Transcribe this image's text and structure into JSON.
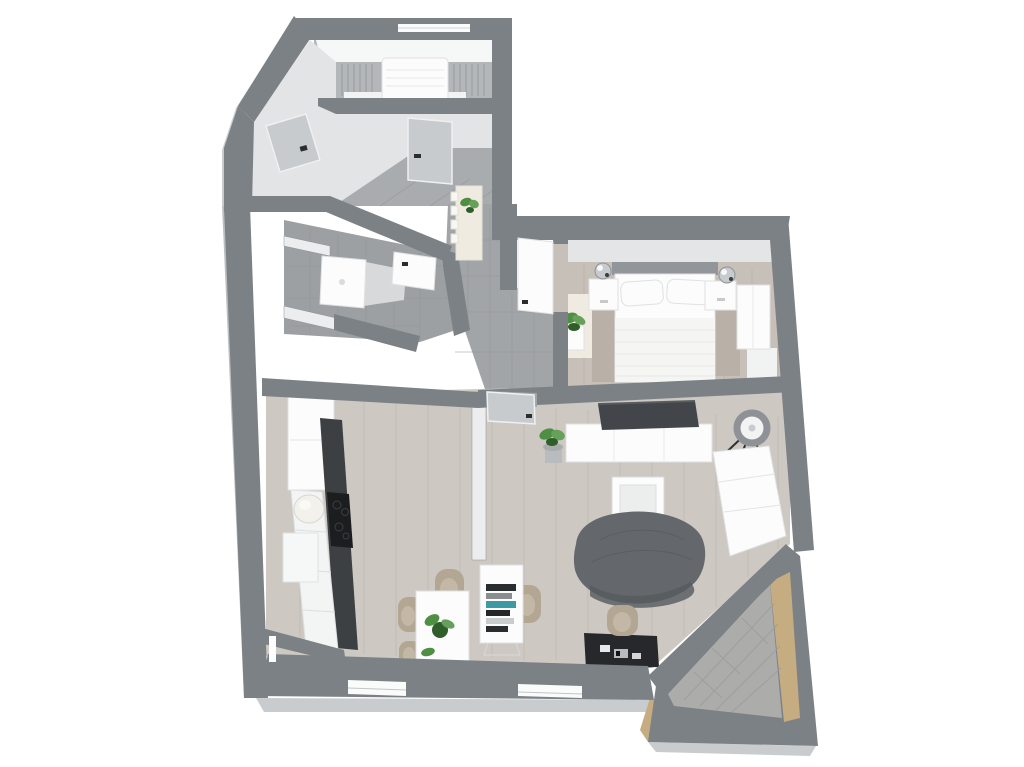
{
  "meta": {
    "description": "3D rendered top-down floor plan of a one-bedroom apartment with bathroom, entry hall, shower room, hallway, bedroom, open kitchen and living room, and a triangular tiled terrace",
    "canvas": {
      "width": 1024,
      "height": 767
    }
  },
  "colors": {
    "bg": "#ffffff",
    "wall": "#7c8185",
    "wallFace": "#c9cccf",
    "wallFaceDark": "#bcbfc2",
    "whiteWall": "#ecedee",
    "floorWood": "#cdc8c2",
    "floorWoodSeam": "#bab3ab",
    "floorWoodDark": "#b9b1a7",
    "floorBedroom": "#c7c0b8",
    "floorBedroomSeam": "#b4ada4",
    "tileHall": "#a2a5a8",
    "tileEntry": "#a9acae",
    "tileWC": "#9ca0a3",
    "tileSeam": "#8f9295",
    "tileBathWall": "#b3b7ba",
    "bathHatch": "#9fa3a6",
    "floorLight": "#e3e4e5",
    "cream": "#efebe0",
    "terrTile": "#acacaa",
    "terrSeam": "#9b9b98",
    "terrTrim": "#c5ac81",
    "white": "#fcfcfd",
    "furnitureBorder": "#dfe1e3",
    "backWall": "#e4e5e6",
    "tv": "#42464a",
    "sofa": "#64686c",
    "sofaDark": "#555a5e",
    "desk": "#26282b",
    "counter": "#3c4043",
    "cooktop": "#1b1d1f",
    "chairTan": "#b3a794",
    "chairTanInner": "#c3b8a5",
    "plantGreen": "#4e8f44",
    "plantGreen2": "#67a05b",
    "plantDark": "#2f5e2b",
    "chrome": "#c8cbcd",
    "chromeRim": "#8f9396",
    "doorGray": "#c8cbcd",
    "handle": "#2b2d2f",
    "potGray": "#b9bcbe",
    "windowWhite": "#fafbfb"
  },
  "scene": {
    "rooms": [
      {
        "id": "bathroom"
      },
      {
        "id": "entry-hall"
      },
      {
        "id": "shower-room"
      },
      {
        "id": "hallway"
      },
      {
        "id": "bedroom"
      },
      {
        "id": "living-room"
      },
      {
        "id": "kitchen"
      },
      {
        "id": "terrace"
      }
    ],
    "furniture": [
      {
        "id": "bathtub",
        "room": "bathroom"
      },
      {
        "id": "shower-tray",
        "room": "shower-room"
      },
      {
        "id": "hall-wardrobe",
        "room": "hallway"
      },
      {
        "id": "bed",
        "room": "bedroom"
      },
      {
        "id": "nightstand-left",
        "room": "bedroom"
      },
      {
        "id": "nightstand-right",
        "room": "bedroom"
      },
      {
        "id": "bedside-lamp-left",
        "room": "bedroom"
      },
      {
        "id": "bedside-lamp-right",
        "room": "bedroom"
      },
      {
        "id": "bedroom-wardrobe",
        "room": "bedroom"
      },
      {
        "id": "tv-sideboard",
        "room": "living-room"
      },
      {
        "id": "tv",
        "room": "living-room"
      },
      {
        "id": "floor-lamp",
        "room": "living-room"
      },
      {
        "id": "drawer-cabinet",
        "room": "living-room"
      },
      {
        "id": "coffee-table",
        "room": "living-room"
      },
      {
        "id": "sofa",
        "room": "living-room"
      },
      {
        "id": "desk",
        "room": "living-room"
      },
      {
        "id": "desk-chair",
        "room": "living-room"
      },
      {
        "id": "bookshelf",
        "room": "living-room"
      },
      {
        "id": "dining-table",
        "room": "kitchen"
      },
      {
        "id": "dining-chairs",
        "room": "kitchen",
        "count": 4
      },
      {
        "id": "kitchen-counter",
        "room": "kitchen"
      },
      {
        "id": "fridge-cabinet",
        "room": "kitchen"
      },
      {
        "id": "cooktop",
        "room": "kitchen"
      },
      {
        "id": "trash-bin",
        "room": "kitchen"
      },
      {
        "id": "plants",
        "count": 5
      }
    ],
    "doors": [
      {
        "id": "entry-door"
      },
      {
        "id": "bathroom-door"
      },
      {
        "id": "shower-room-door"
      },
      {
        "id": "bedroom-door"
      },
      {
        "id": "living-room-door"
      }
    ]
  }
}
